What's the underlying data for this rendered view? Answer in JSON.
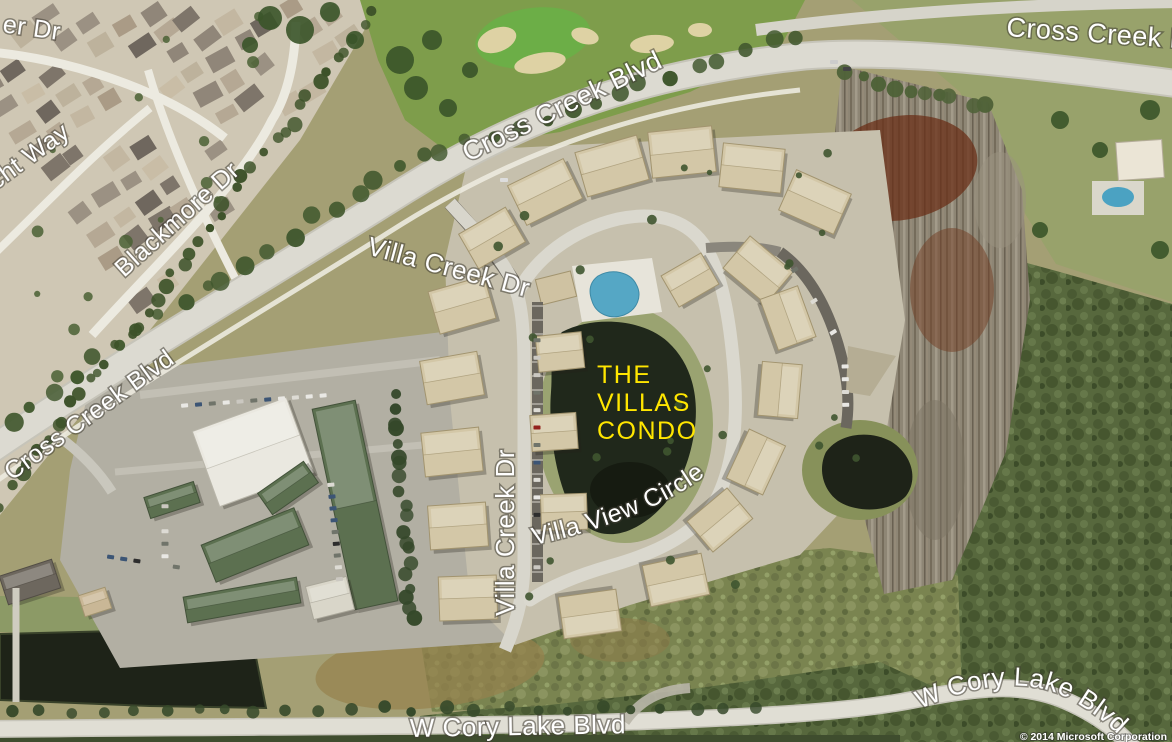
{
  "map": {
    "type": "aerial-satellite-view",
    "label_color": "#ffffff",
    "streets": [
      {
        "id": "er-dr",
        "text": "er Dr"
      },
      {
        "id": "cht-way",
        "text": "cht Way"
      },
      {
        "id": "blackmore-dr",
        "text": "Blackmore Dr"
      },
      {
        "id": "cross-creek-blvd-west",
        "text": "Cross Creek Blvd"
      },
      {
        "id": "cross-creek-blvd-central",
        "text": "Cross Creek Blvd"
      },
      {
        "id": "cross-creek-blvd-northeast",
        "text": "Cross Creek Blvd"
      },
      {
        "id": "villa-creek-dr-north",
        "text": "Villa Creek Dr"
      },
      {
        "id": "villa-creek-dr-south",
        "text": "Villa Creek Dr"
      },
      {
        "id": "villa-view-circle",
        "text": "Villa View Circle"
      },
      {
        "id": "w-cory-lake-blvd-south",
        "text": "W Cory Lake Blvd"
      },
      {
        "id": "w-cory-lake-blvd-southeast",
        "text": "W Cory Lake Blvd"
      }
    ],
    "poi": {
      "name": "THE VILLAS CONDO",
      "lines": [
        "THE",
        "VILLAS",
        "CONDO"
      ],
      "label_color": "#ffe600"
    },
    "attribution": "© 2014 Microsoft Corporation"
  }
}
